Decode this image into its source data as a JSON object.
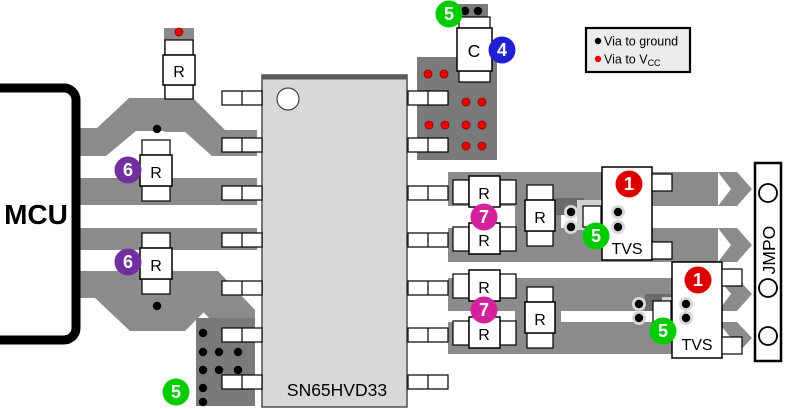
{
  "labels": {
    "mcu": "MCU",
    "chip": "SN65HVD33",
    "resistor": "R",
    "capacitor": "C",
    "tvs": "TVS",
    "connector": "JMPO"
  },
  "legend": {
    "ground_label": "Via to ground",
    "vcc_label": "Via to V",
    "vcc_sub": "CC"
  },
  "colors": {
    "trace": "#8b8b8b",
    "via_region": "#7a7a7a",
    "ground_via": "#000000",
    "vcc_via": "#ee0000",
    "callout_green": "#00cc00",
    "callout_red": "#dd0000",
    "callout_purple": "#7030a0",
    "callout_magenta": "#d4219c",
    "callout_blue": "#2020d0"
  },
  "callouts": [
    {
      "num": "5",
      "color": "#00cc00",
      "x": 449,
      "y": 14
    },
    {
      "num": "4",
      "color": "#2020d0",
      "x": 502,
      "y": 50
    },
    {
      "num": "6",
      "color": "#7030a0",
      "x": 128,
      "y": 170
    },
    {
      "num": "6",
      "color": "#7030a0",
      "x": 128,
      "y": 262
    },
    {
      "num": "7",
      "color": "#d4219c",
      "x": 484,
      "y": 217
    },
    {
      "num": "7",
      "color": "#d4219c",
      "x": 484,
      "y": 310
    },
    {
      "num": "1",
      "color": "#dd0000",
      "x": 629,
      "y": 184
    },
    {
      "num": "1",
      "color": "#dd0000",
      "x": 698,
      "y": 280
    },
    {
      "num": "5",
      "color": "#00cc00",
      "x": 596,
      "y": 236
    },
    {
      "num": "5",
      "color": "#00cc00",
      "x": 663,
      "y": 331
    },
    {
      "num": "5",
      "color": "#00cc00",
      "x": 176,
      "y": 392
    }
  ],
  "vias": {
    "ground": [
      {
        "x": 465,
        "y": 11
      },
      {
        "x": 478,
        "y": 11
      },
      {
        "x": 157,
        "y": 129
      },
      {
        "x": 157,
        "y": 306
      },
      {
        "x": 203,
        "y": 333
      },
      {
        "x": 203,
        "y": 352
      },
      {
        "x": 219,
        "y": 352
      },
      {
        "x": 238,
        "y": 352
      },
      {
        "x": 203,
        "y": 370
      },
      {
        "x": 219,
        "y": 370
      },
      {
        "x": 238,
        "y": 370
      },
      {
        "x": 203,
        "y": 388
      },
      {
        "x": 203,
        "y": 402
      }
    ],
    "ground_haloed": [
      {
        "x": 571,
        "y": 212
      },
      {
        "x": 571,
        "y": 227
      },
      {
        "x": 618,
        "y": 212
      },
      {
        "x": 618,
        "y": 227
      },
      {
        "x": 639,
        "y": 304
      },
      {
        "x": 639,
        "y": 318
      },
      {
        "x": 686,
        "y": 304
      },
      {
        "x": 686,
        "y": 318
      }
    ],
    "vcc": [
      {
        "x": 179,
        "y": 32
      },
      {
        "x": 428,
        "y": 74
      },
      {
        "x": 444,
        "y": 74
      },
      {
        "x": 466,
        "y": 102
      },
      {
        "x": 482,
        "y": 102
      },
      {
        "x": 429,
        "y": 125
      },
      {
        "x": 445,
        "y": 125
      },
      {
        "x": 466,
        "y": 125
      },
      {
        "x": 482,
        "y": 125
      },
      {
        "x": 466,
        "y": 146
      },
      {
        "x": 482,
        "y": 146
      }
    ]
  }
}
